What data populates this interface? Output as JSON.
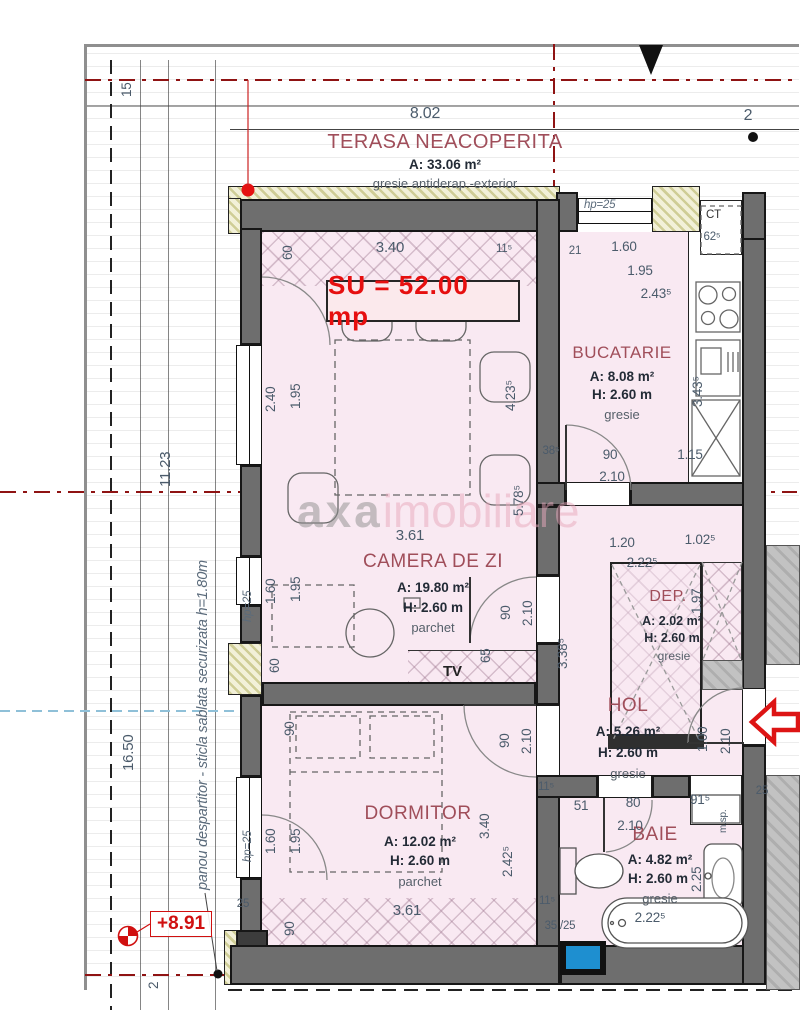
{
  "plan": {
    "su_label": "SU = 52.00 mp",
    "level_label": "+8.91",
    "divider_note": "panou despartitor - sticla sablata securizata h=1.80m",
    "watermark_part1": "axa",
    "watermark_part2": "imobiliare",
    "accent_red": "#e60f0f",
    "axis_red": "#8f1313",
    "room_fill_pink": "#f9e9f2",
    "wall_gray": "#6e6e6e"
  },
  "rooms": {
    "terasa": {
      "name": "TERASA NEACOPERITA",
      "area": "A: 33.06 m²",
      "floor": "gresie antiderap.-exterior"
    },
    "bucatarie": {
      "name": "BUCATARIE",
      "area": "A: 8.08 m²",
      "height": "H: 2.60 m",
      "floor": "gresie"
    },
    "camera": {
      "name": "CAMERA DE ZI",
      "area": "A: 19.80 m²",
      "height": "H: 2.60 m",
      "floor": "parchet"
    },
    "dep": {
      "name": "DEP.",
      "area": "A: 2.02 m²",
      "height": "H: 2.60 m",
      "floor": "gresie"
    },
    "hol": {
      "name": "HOL",
      "area": "A: 5.26 m²",
      "height": "H: 2.60 m",
      "floor": "gresie"
    },
    "dormitor": {
      "name": "DORMITOR",
      "area": "A: 12.02 m²",
      "height": "H: 2.60 m",
      "floor": "parchet"
    },
    "baie": {
      "name": "BAIE",
      "area": "A: 4.82 m²",
      "height": "H: 2.60 m",
      "floor": "gresie"
    }
  },
  "labels": {
    "tv": "TV",
    "ct": "CT",
    "msp": "m.sp.",
    "hp25": "hp=25"
  },
  "dims": [
    "8.02",
    "2",
    "15",
    "11.23",
    "16.50",
    "2",
    "60",
    "3.40",
    "11⁵",
    "21",
    "1.60",
    "1.95",
    "2.43⁵",
    "2.40",
    "1.95",
    "4.23⁵",
    "5.78⁵",
    "3.43⁵",
    "38⁵",
    "90",
    "2.10",
    "1.15",
    "3.61",
    "1.60",
    "1.95",
    "60",
    "90",
    "2.10",
    "65",
    "3.38⁵",
    "1.20",
    "1.02⁵",
    "2.22⁵",
    "1.97",
    "1.00",
    "2.10",
    "90",
    "90",
    "2.10",
    "3.40",
    "2.42⁵",
    "1.60",
    "1.95",
    "3.61",
    "90",
    "25",
    "11⁵",
    "51",
    "80",
    "91⁵",
    "2.10",
    "2.25",
    "2.22⁵",
    "25",
    "35 /25",
    "11⁵",
    "62⁵"
  ]
}
